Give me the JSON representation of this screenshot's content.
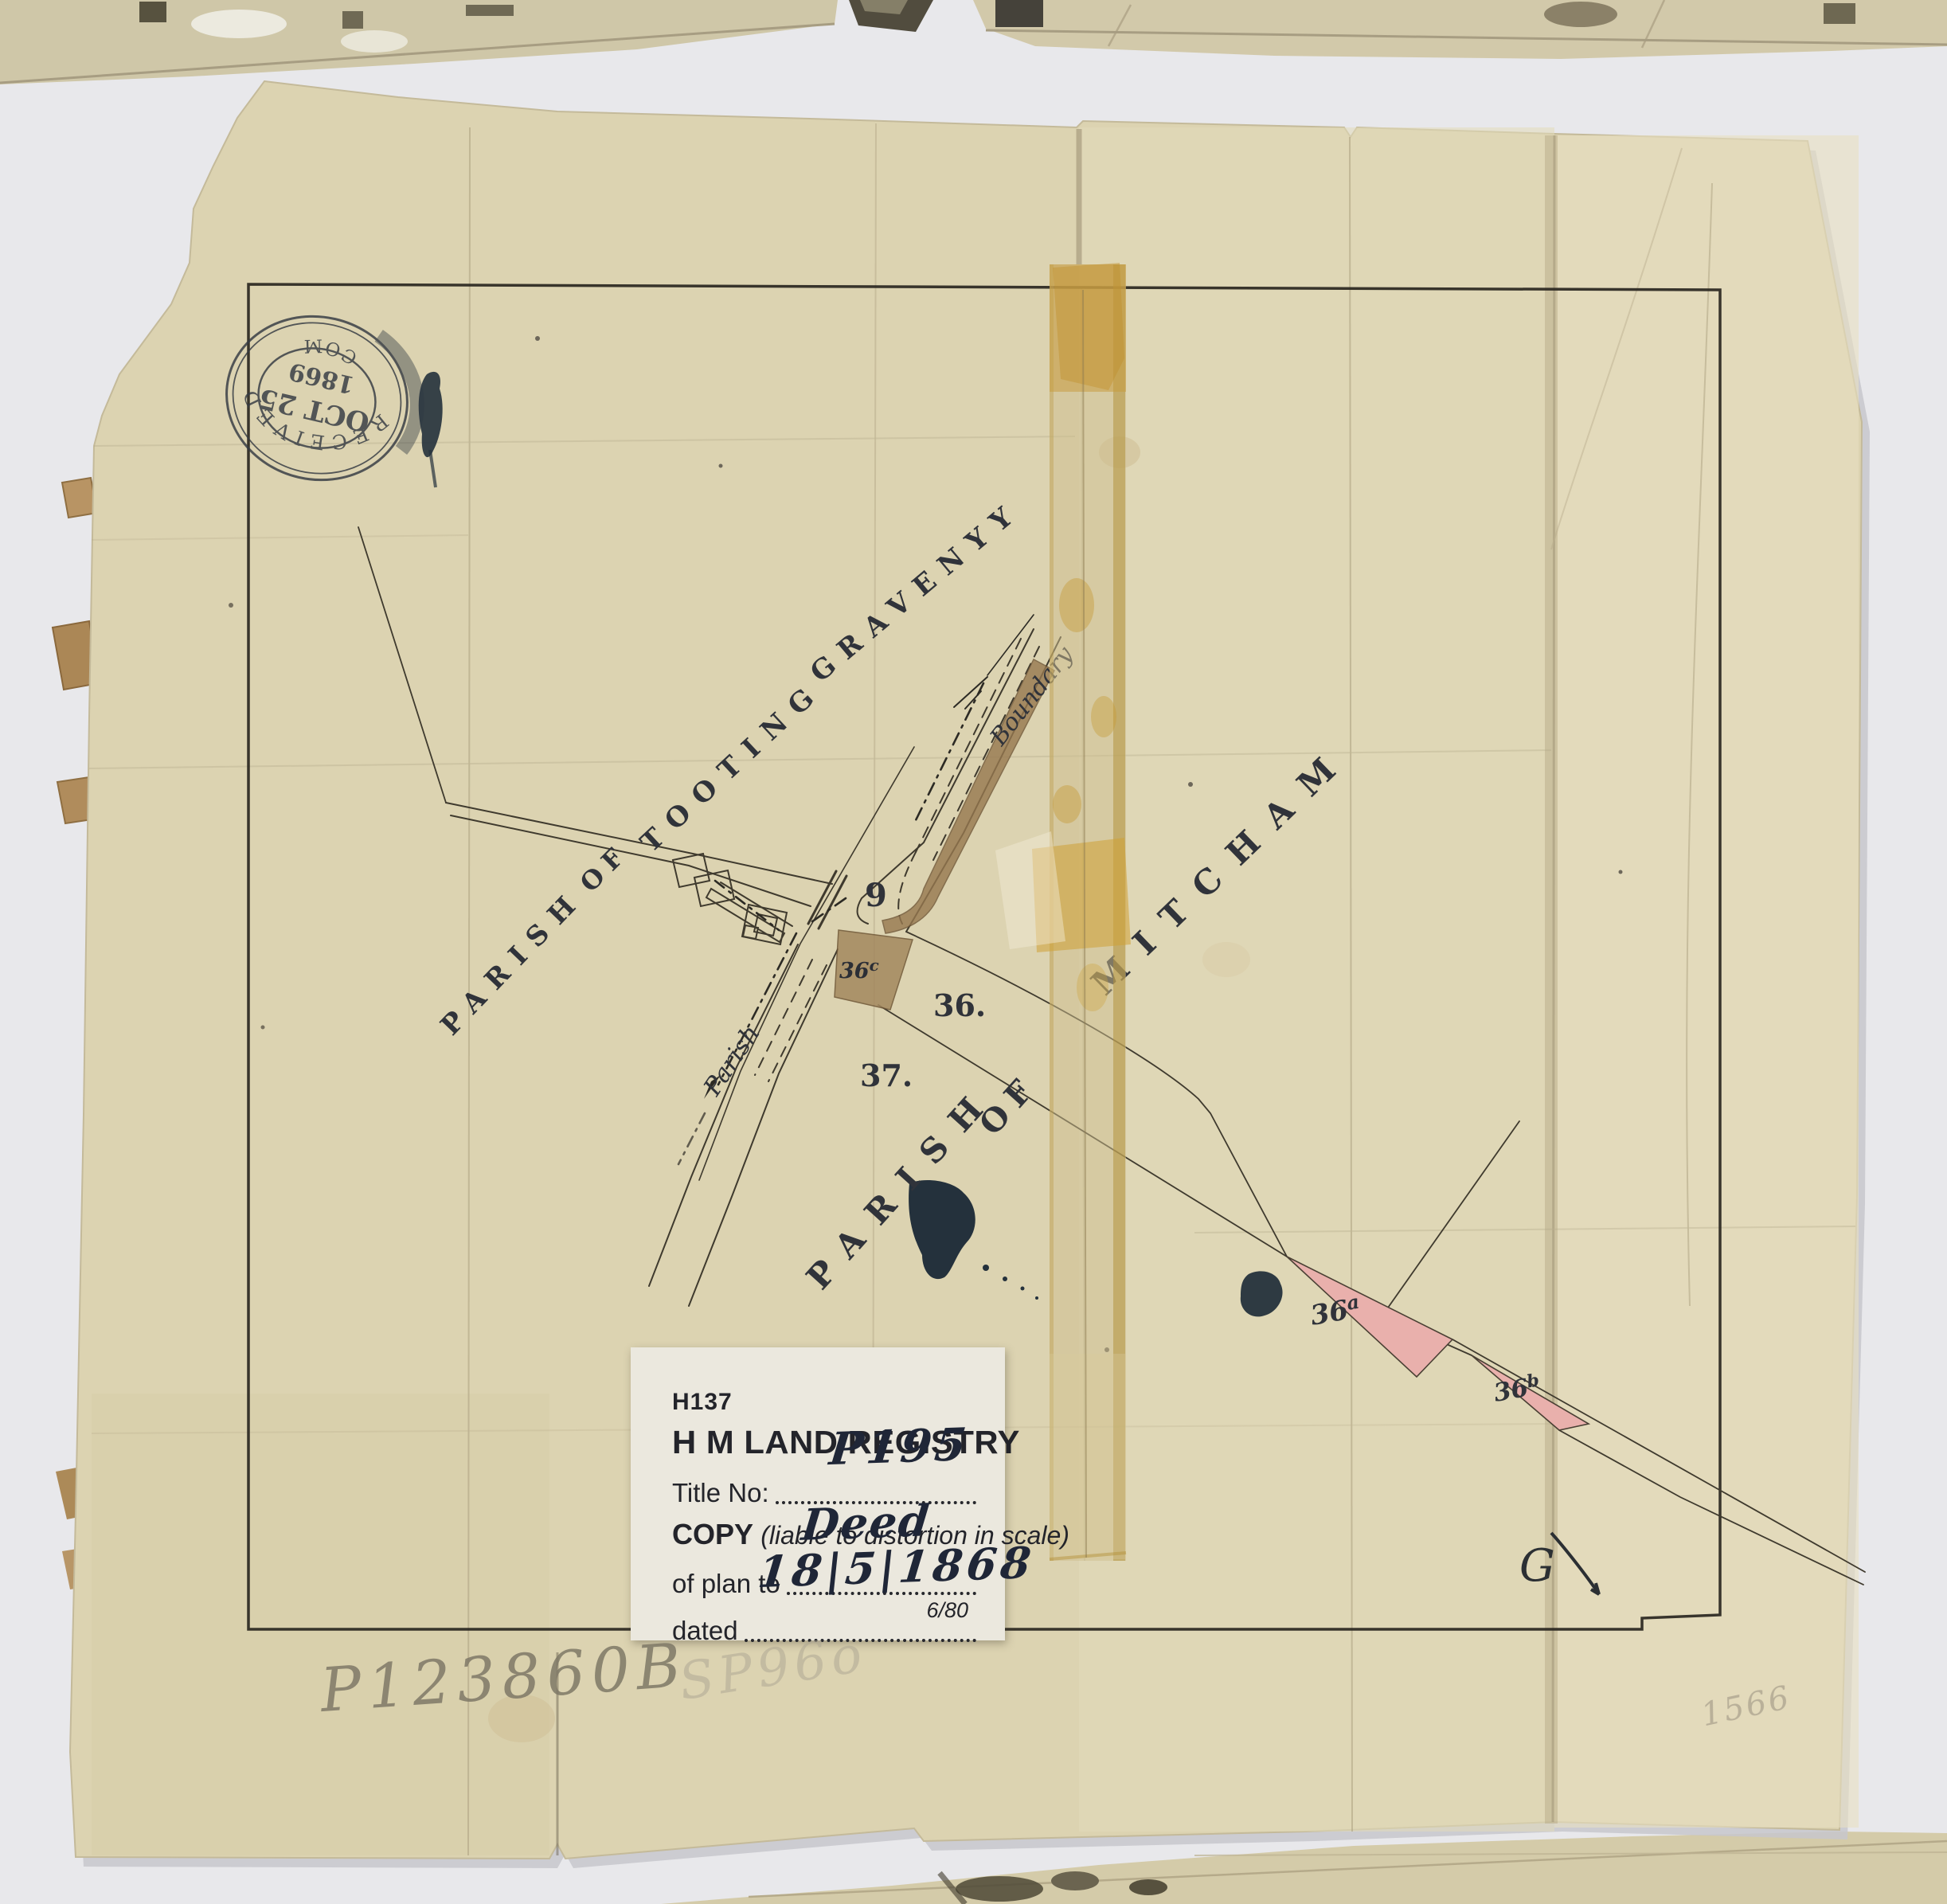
{
  "stamp": {
    "line1": "RECEIVED",
    "date_top": "OCT 25",
    "year": "1869",
    "line2": "COM"
  },
  "map": {
    "parish_tooting": {
      "w1": "PARISH",
      "w2": "OF",
      "w3": "TOOTING",
      "w4": "GRAVENYY"
    },
    "parish_mitcham": {
      "w1": "PARISH",
      "w2": "OF",
      "w3": "MITCHAM"
    },
    "boundary_label": "Boundary",
    "parish_small": "Parish",
    "parcels": {
      "p9": "9",
      "p36": "36.",
      "p37": "37.",
      "p36c_base": "36",
      "p36c_sup": "c",
      "p36a_base": "36",
      "p36a_sup": "a",
      "p36b_base": "36",
      "p36b_sup": "b"
    }
  },
  "label": {
    "form_no": "H137",
    "title": "H M LAND REGISTRY",
    "title_no_label": "Title No:",
    "title_no_value": "P195",
    "copy_bold": "COPY",
    "copy_italic": "(liable to distortion in scale)",
    "of_plan_label": "of plan to",
    "of_plan_value": "Deed",
    "dated_label": "dated",
    "dated_value": "18|5|1868",
    "print_code": "6/80"
  },
  "annotations": {
    "pencil_ref": "P123860B",
    "pencil_ref2": "SP96o",
    "pencil_ref3": "1566",
    "ink_initial": "G"
  },
  "colors": {
    "paper": "#dcd3b1",
    "parcel_pink": "#e9b0ac",
    "road_brown": "#96784f",
    "tape_amber": "#c79a3a",
    "ink_blot": "#24313c",
    "stamp_ink": "#343a42"
  }
}
